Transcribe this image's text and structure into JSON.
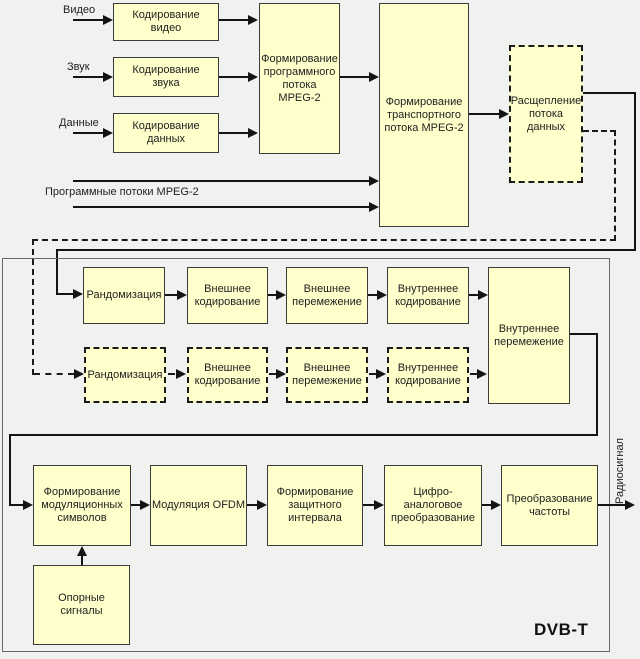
{
  "diagram": {
    "standard_label": "DVB-T",
    "output_label": "Радиосигнал",
    "program_streams_label": "Программные потоки MPEG-2",
    "inputs": {
      "video": "Видео",
      "audio": "Звук",
      "data": "Данные"
    },
    "blocks": {
      "encode_video": "Кодирование\nвидео",
      "encode_audio": "Кодирование\nзвука",
      "encode_data": "Кодирование\nданных",
      "program_stream": "Формирование\nпрограммного\nпотока\nMPEG-2",
      "transport_stream": "Формирование\nтранспортного\nпотока MPEG-2",
      "stream_split": "Расщепление\nпотока данных",
      "randomization_main": "Рандомизация",
      "outer_coding_main": "Внешнее\nкодирование",
      "outer_interleaving_main": "Внешнее\nперемежение",
      "inner_coding_main": "Внутреннее\nкодирование",
      "randomization_alt": "Рандомизация",
      "outer_coding_alt": "Внешнее\nкодирование",
      "outer_interleaving_alt": "Внешнее\nперемежение",
      "inner_coding_alt": "Внутреннее\nкодирование",
      "inner_interleaving": "Внутреннее\nперемежение",
      "symbol_mapping": "Формирование\nмодуляционных\nсимволов",
      "ofdm_modulation": "Модуляция OFDM",
      "guard_interval": "Формирование\nзащитного\nинтервала",
      "dac": "Цифро-аналоговое\nпреобразование",
      "frequency_conversion": "Преобразование\nчастоты",
      "reference_signals": "Опорные\nсигналы"
    },
    "colors": {
      "block_fill": "#ffffcc",
      "block_border": "#3c3c3c",
      "line": "#141414",
      "frame_border": "#6a6a6a",
      "background": "#f1f1ef"
    }
  }
}
